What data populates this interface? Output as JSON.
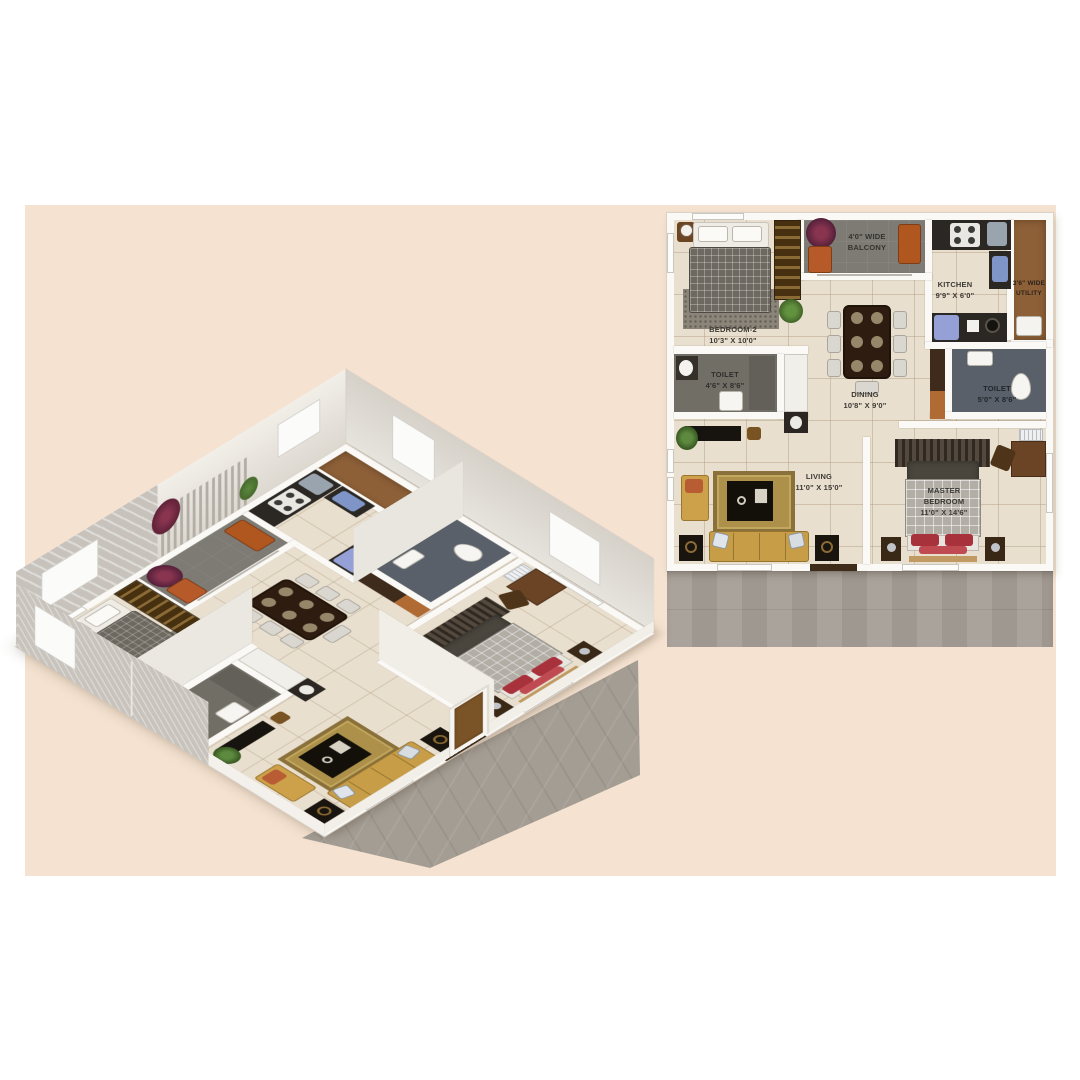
{
  "scene": {
    "background": "#ffffff",
    "band_color": "#f5e2d0",
    "floor_tile_color": "#e9dfce",
    "ground_shadow_color": "#a49d94",
    "label_color": "#3b3934"
  },
  "plan3d": {
    "description": "3D isometric cutaway render of the same apartment, no text labels"
  },
  "plan2d": {
    "rooms": [
      {
        "key": "bedroom2",
        "line1": "BEDROOM-2",
        "dims": "10'3\" X 10'0\""
      },
      {
        "key": "balcony",
        "line1": "4'0\" WIDE",
        "line2": "BALCONY"
      },
      {
        "key": "kitchen",
        "line1": "KITCHEN",
        "dims": "9'9\" X 6'0\""
      },
      {
        "key": "utility",
        "line1": "3'6\" WIDE",
        "line2": "UTILITY"
      },
      {
        "key": "toilet1",
        "line1": "TOILET",
        "dims": "4'6\" X 8'6\""
      },
      {
        "key": "dining",
        "line1": "DINING",
        "dims": "10'8\" X 9'0\""
      },
      {
        "key": "toilet2",
        "line1": "TOILET",
        "dims": "5'0\" X 8'6\""
      },
      {
        "key": "living",
        "line1": "LIVING",
        "dims": "11'0\" X 15'0\""
      },
      {
        "key": "master",
        "line1": "MASTER",
        "line2": "BEDROOM",
        "dims": "11'0\" X 14'6\""
      }
    ]
  }
}
